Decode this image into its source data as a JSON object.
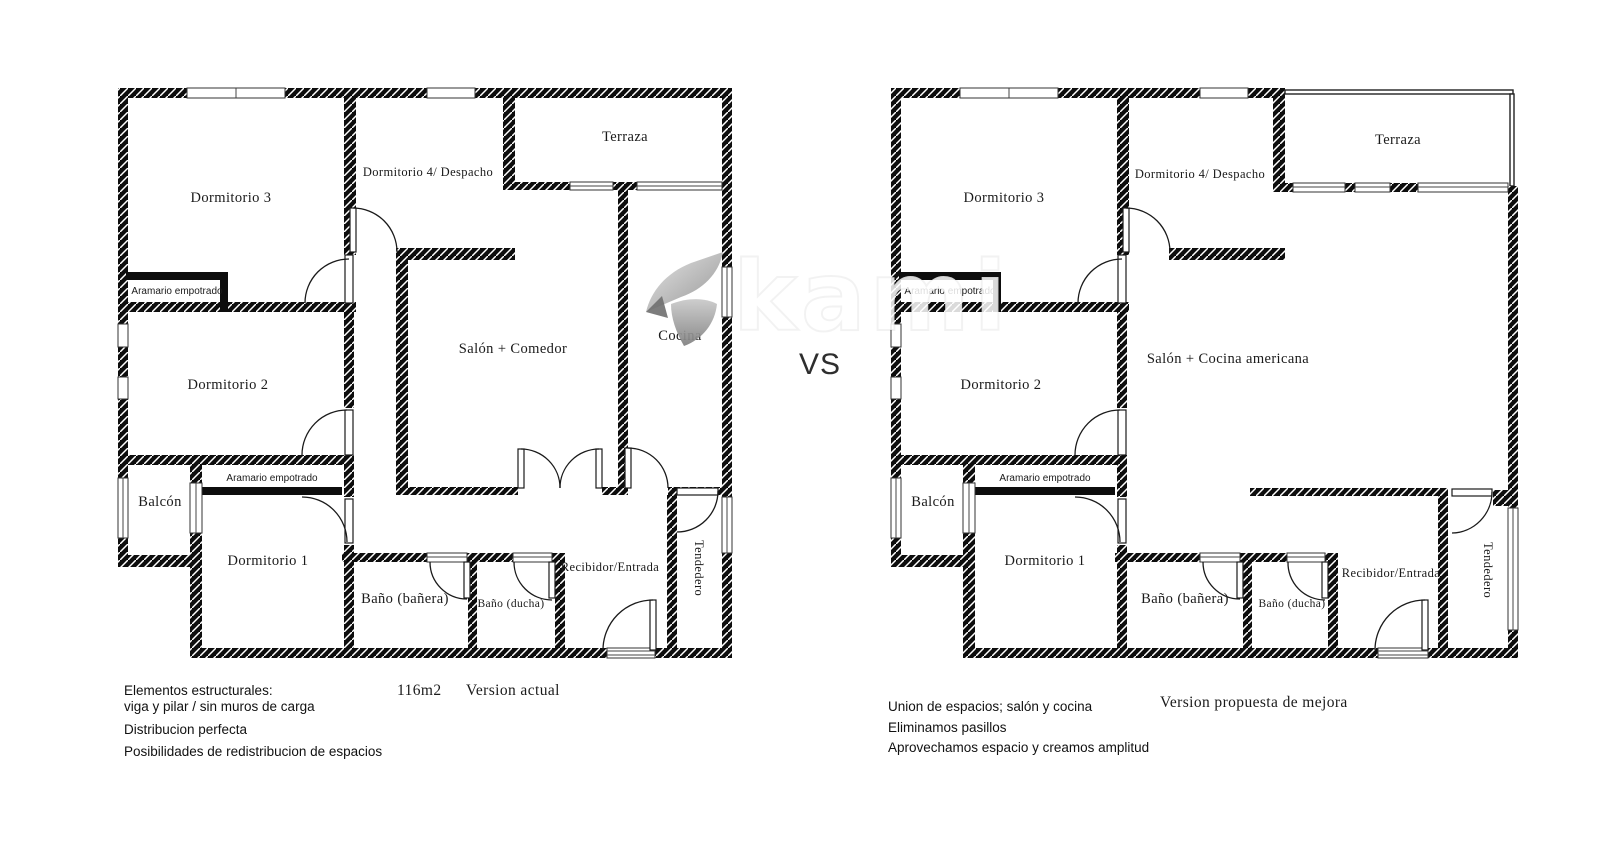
{
  "divider": {
    "vs": "VS"
  },
  "watermark": {
    "text": "kami",
    "logo": "ribbon-logo"
  },
  "colors": {
    "wall": "#0d0d0d",
    "background": "#ffffff",
    "text": "#1a1a1a",
    "watermark_grey": "#9a9a9a"
  },
  "left_plan": {
    "title": "Version actual",
    "area": "116m2",
    "rooms": {
      "dormitorio3": "Dormitorio 3",
      "dormitorio4": "Dormitorio 4/ Despacho",
      "terraza": "Terraza",
      "armario_sup": "Aramario empotrado",
      "dormitorio2": "Dormitorio 2",
      "salon": "Salón + Comedor",
      "cocina": "Cocina",
      "balcon": "Balcón",
      "armario_inf": "Aramario empotrado",
      "dormitorio1": "Dormitorio 1",
      "bano_banera": "Baño (bañera)",
      "bano_ducha": "Baño (ducha)",
      "recibidor": "Recibidor/Entrada",
      "tendedero": "Tendedero"
    },
    "notes": {
      "line1": "Elementos estructurales:",
      "line2": "viga y pilar / sin muros de carga",
      "line3": "Distribucion perfecta",
      "line4": "Posibilidades de redistribucion de espacios"
    }
  },
  "right_plan": {
    "title": "Version propuesta de mejora",
    "rooms": {
      "dormitorio3": "Dormitorio 3",
      "dormitorio4": "Dormitorio 4/ Despacho",
      "terraza": "Terraza",
      "armario_sup": "Aramario empotrado",
      "dormitorio2": "Dormitorio 2",
      "salon": "Salón + Cocina americana",
      "balcon": "Balcón",
      "armario_inf": "Aramario empotrado",
      "dormitorio1": "Dormitorio 1",
      "bano_banera": "Baño (bañera)",
      "bano_ducha": "Baño (ducha)",
      "recibidor": "Recibidor/Entrada",
      "tendedero": "Tendedero"
    },
    "notes": {
      "line1": "Union de espacios; salón y cocina",
      "line2": "Eliminamos pasillos",
      "line3": "Aprovechamos espacio y creamos amplitud"
    }
  }
}
